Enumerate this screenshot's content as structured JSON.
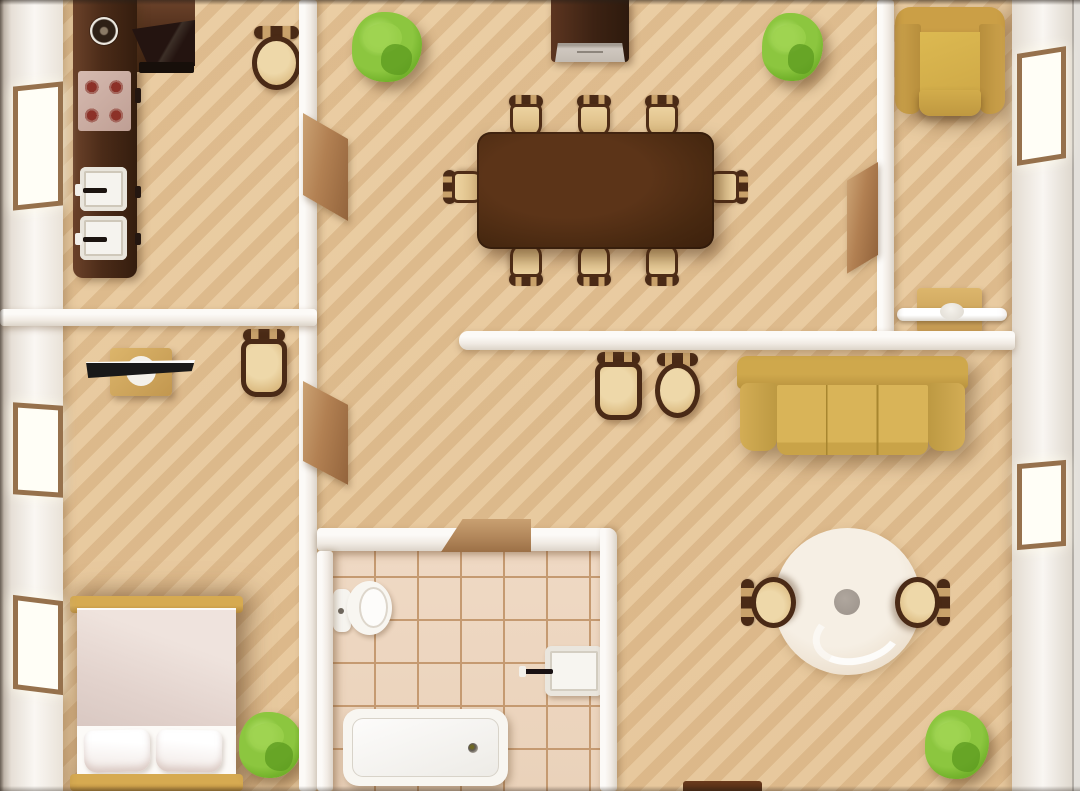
{
  "meta": {
    "title": "apartment-floor-plan-top-view",
    "width": 1080,
    "height": 791,
    "text_content": "none — illustration only"
  },
  "palette": {
    "floor": "#eacda3",
    "floor_stripe": "#c1925c",
    "wall": "#f6f2ed",
    "wall_shade": "#dcd4c9",
    "wood_dark": "#4b2b18",
    "wood_mid": "#5c3418",
    "seat_tan": "#e2c189",
    "chair_frame": "#4a2a16",
    "sofa_gold": "#cda84c",
    "armchair_gold": "#cb9f46",
    "bed_frame_gold": "#d6aa51",
    "blanket_pink": "#e2d2cc",
    "plant_green": "#8cc63f",
    "plant_dark": "#5e9c21",
    "tile": "#efd9c4",
    "grout": "#c59a71",
    "door_brown": "#b28052",
    "window_frame": "#96714c",
    "rug_cream": "#f0e6d8",
    "rug_dot_gray": "#a39a91",
    "fixture_white": "#f8f6f1",
    "stove_pink": "#d6bab0",
    "burner_red": "#8c3128",
    "tv_black": "#191919"
  },
  "rooms": [
    {
      "name": "kitchen",
      "x": 63,
      "y": 0,
      "w": 236,
      "h": 309
    },
    {
      "name": "dining-room",
      "x": 317,
      "y": 0,
      "w": 560,
      "h": 331
    },
    {
      "name": "top-right-room",
      "x": 894,
      "y": 0,
      "w": 118,
      "h": 331
    },
    {
      "name": "bedroom",
      "x": 63,
      "y": 326,
      "w": 236,
      "h": 465
    },
    {
      "name": "hall",
      "x": 317,
      "y": 350,
      "w": 142,
      "h": 178
    },
    {
      "name": "bathroom",
      "x": 333,
      "y": 551,
      "w": 267,
      "h": 240
    },
    {
      "name": "living-room",
      "x": 617,
      "y": 350,
      "w": 395,
      "h": 441
    }
  ],
  "elements": [
    {
      "n": "bathroom-tile-floor",
      "k": "bath-floor",
      "x": 333,
      "y": 551,
      "w": 267,
      "h": 240
    },
    {
      "n": "living-room-rug",
      "k": "rug",
      "x": 774,
      "y": 528,
      "w": 147,
      "h": 147,
      "ch": [
        {
          "n": "rug-center-table",
          "k": "rug-dot",
          "x": 60,
          "y": 61,
          "w": 26,
          "h": 26
        }
      ]
    },
    {
      "n": "kitchen-counter-top-run",
      "k": "kcounter-h",
      "x": 73,
      "y": 0,
      "w": 122,
      "h": 72
    },
    {
      "n": "kitchen-counter-side-run",
      "k": "kcounter-v",
      "x": 73,
      "y": 0,
      "w": 64,
      "h": 278
    },
    {
      "n": "kitchen-corner-appliance",
      "k": "kappliance",
      "x": 132,
      "y": 20,
      "w": 63,
      "h": 46
    },
    {
      "n": "kitchen-appliance-bar",
      "k": "kbar",
      "x": 139,
      "y": 62,
      "w": 55,
      "h": 11
    },
    {
      "n": "kitchen-pot",
      "k": "pot",
      "x": 90,
      "y": 17,
      "w": 28,
      "h": 28
    },
    {
      "n": "kitchen-stove",
      "k": "stove",
      "x": 78,
      "y": 71,
      "w": 53,
      "h": 60
    },
    {
      "n": "kitchen-sink-upper",
      "k": "ksink",
      "x": 80,
      "y": 167,
      "w": 47,
      "h": 44
    },
    {
      "n": "kitchen-sink-lower",
      "k": "ksink",
      "x": 80,
      "y": 216,
      "w": 47,
      "h": 44
    },
    {
      "n": "kitchen-handle-1",
      "k": "knob",
      "x": 135,
      "y": 88,
      "w": 6,
      "h": 15
    },
    {
      "n": "kitchen-handle-2",
      "k": "knob",
      "x": 135,
      "y": 186,
      "w": 6,
      "h": 12
    },
    {
      "n": "kitchen-handle-3",
      "k": "knob",
      "x": 135,
      "y": 233,
      "w": 6,
      "h": 12
    },
    {
      "n": "kitchen-stool",
      "k": "stool",
      "x": 249,
      "y": 26,
      "w": 55,
      "h": 66
    },
    {
      "n": "dining-cabinet",
      "k": "cabinet",
      "x": 551,
      "y": 0,
      "w": 78,
      "h": 62,
      "ch": [
        {
          "n": "dining-cabinet-front",
          "k": "cabinet-front",
          "x": 4,
          "y": 43,
          "w": 70,
          "h": 19
        }
      ]
    },
    {
      "n": "plant-dining-left",
      "k": "plant",
      "x": 352,
      "y": 12,
      "w": 70,
      "h": 70
    },
    {
      "n": "plant-dining-right",
      "k": "plant",
      "x": 762,
      "y": 13,
      "w": 61,
      "h": 68
    },
    {
      "n": "dining-chair-top-1",
      "k": "dchair",
      "x": 504,
      "y": 95,
      "w": 44,
      "h": 46
    },
    {
      "n": "dining-chair-top-2",
      "k": "dchair",
      "x": 572,
      "y": 95,
      "w": 44,
      "h": 46
    },
    {
      "n": "dining-chair-top-3",
      "k": "dchair",
      "x": 640,
      "y": 95,
      "w": 44,
      "h": 46
    },
    {
      "n": "dining-chair-left",
      "k": "dchair dchair--l",
      "x": 444,
      "y": 164,
      "w": 44,
      "h": 46
    },
    {
      "n": "dining-chair-right",
      "k": "dchair dchair--r",
      "x": 703,
      "y": 164,
      "w": 44,
      "h": 46
    },
    {
      "n": "dining-chair-bottom-1",
      "k": "dchair dchair--b",
      "x": 504,
      "y": 240,
      "w": 44,
      "h": 46
    },
    {
      "n": "dining-chair-bottom-2",
      "k": "dchair dchair--b",
      "x": 572,
      "y": 240,
      "w": 44,
      "h": 46
    },
    {
      "n": "dining-chair-bottom-3",
      "k": "dchair dchair--b",
      "x": 640,
      "y": 240,
      "w": 44,
      "h": 46
    },
    {
      "n": "dining-table",
      "k": "table-dining",
      "x": 477,
      "y": 132,
      "w": 237,
      "h": 117
    },
    {
      "n": "living-stool-square",
      "k": "stool stool--sq",
      "x": 592,
      "y": 352,
      "w": 53,
      "h": 70
    },
    {
      "n": "living-stool-round",
      "k": "stool",
      "x": 652,
      "y": 353,
      "w": 51,
      "h": 67
    },
    {
      "n": "sofa",
      "k": "sofa",
      "x": 737,
      "y": 356,
      "w": 231,
      "h": 101,
      "ch": [
        {
          "n": "sofa-back",
          "k": "sofa-back",
          "x": 0,
          "y": 0,
          "w": 231,
          "h": 33
        },
        {
          "n": "sofa-arm-left",
          "k": "sofa-arm",
          "x": 3,
          "y": 27,
          "w": 37,
          "h": 68
        },
        {
          "n": "sofa-arm-right",
          "k": "sofa-arm sofa-arm--r",
          "x": 191,
          "y": 27,
          "w": 37,
          "h": 68
        },
        {
          "n": "sofa-cushions",
          "k": "sofa-seat",
          "x": 40,
          "y": 29,
          "w": 151,
          "h": 70
        }
      ]
    },
    {
      "n": "rug-chair-left",
      "k": "stool stool--rugl",
      "x": 741,
      "y": 574,
      "w": 57,
      "h": 57
    },
    {
      "n": "rug-chair-right",
      "k": "stool stool--rugr",
      "x": 893,
      "y": 574,
      "w": 57,
      "h": 57
    },
    {
      "n": "plant-living",
      "k": "plant",
      "x": 925,
      "y": 710,
      "w": 64,
      "h": 69
    },
    {
      "n": "cropped-table-bottom",
      "k": "croptable",
      "x": 683,
      "y": 781,
      "w": 79,
      "h": 10
    },
    {
      "n": "armchair",
      "k": "armchair",
      "x": 895,
      "y": 7,
      "w": 110,
      "h": 112,
      "ch": [
        {
          "n": "armchair-back",
          "k": "arm-back",
          "x": 0,
          "y": 0,
          "w": 110,
          "h": 38
        },
        {
          "n": "armchair-arm-left",
          "k": "arm-side",
          "x": 0,
          "y": 17,
          "w": 26,
          "h": 90
        },
        {
          "n": "armchair-arm-right",
          "k": "arm-side arm-side--r",
          "x": 84,
          "y": 17,
          "w": 26,
          "h": 90
        },
        {
          "n": "armchair-seat",
          "k": "arm-seat",
          "x": 25,
          "y": 25,
          "w": 60,
          "h": 64
        },
        {
          "n": "armchair-front-cushion",
          "k": "arm-front",
          "x": 24,
          "y": 83,
          "w": 62,
          "h": 26
        }
      ]
    },
    {
      "n": "console",
      "k": "console",
      "x": 897,
      "y": 287,
      "w": 110,
      "h": 47,
      "ch": [
        {
          "n": "console-table",
          "k": "console-table",
          "x": 20,
          "y": 1,
          "w": 65,
          "h": 45
        },
        {
          "n": "console-shelf",
          "k": "console-shelf",
          "x": 0,
          "y": 21,
          "w": 110,
          "h": 13
        },
        {
          "n": "console-knob",
          "k": "console-knob",
          "x": 43,
          "y": 16,
          "w": 24,
          "h": 17
        }
      ]
    },
    {
      "n": "tv-desk",
      "k": "tvdesk",
      "x": 86,
      "y": 344,
      "w": 110,
      "h": 53,
      "ch": [
        {
          "n": "desk-top",
          "k": "desk-top",
          "x": 24,
          "y": 4,
          "w": 62,
          "h": 48
        },
        {
          "n": "tv-stand",
          "k": "tv-stand",
          "x": 40,
          "y": 12,
          "w": 30,
          "h": 30
        },
        {
          "n": "tv-screen",
          "k": "tv-screen",
          "x": 0,
          "y": 16,
          "w": 109,
          "h": 18
        }
      ]
    },
    {
      "n": "desk-chair",
      "k": "stool stool--sq",
      "x": 238,
      "y": 329,
      "w": 52,
      "h": 70
    },
    {
      "n": "bed",
      "k": "bed",
      "x": 70,
      "y": 594,
      "w": 173,
      "h": 197,
      "ch": [
        {
          "n": "bed-headboard",
          "k": "bed-bar",
          "x": 0,
          "y": 2,
          "w": 173,
          "h": 17
        },
        {
          "n": "bed-mattress",
          "k": "bed-body",
          "x": 7,
          "y": 14,
          "w": 159,
          "h": 168
        },
        {
          "n": "bed-blanket",
          "k": "bed-blanket",
          "x": 7,
          "y": 16,
          "w": 159,
          "h": 116
        },
        {
          "n": "bed-pillow-left",
          "k": "bed-pillow",
          "x": 14,
          "y": 136,
          "w": 66,
          "h": 42,
          "t": "rotate(-1.5deg)"
        },
        {
          "n": "bed-pillow-right",
          "k": "bed-pillow",
          "x": 86,
          "y": 136,
          "w": 66,
          "h": 42,
          "t": "rotate(1deg)"
        },
        {
          "n": "bed-footboard",
          "k": "bed-bar",
          "x": 0,
          "y": 180,
          "w": 173,
          "h": 17
        }
      ]
    },
    {
      "n": "plant-bedroom",
      "k": "plant",
      "x": 239,
      "y": 712,
      "w": 63,
      "h": 66
    },
    {
      "n": "toilet",
      "k": "toilet",
      "x": 333,
      "y": 580,
      "w": 59,
      "h": 58,
      "ch": [
        {
          "n": "toilet-tank",
          "k": "toilet-tank",
          "x": 0,
          "y": 9,
          "w": 18,
          "h": 43
        },
        {
          "n": "toilet-bowl",
          "k": "toilet-bowl",
          "x": 14,
          "y": 1,
          "w": 45,
          "h": 54
        }
      ]
    },
    {
      "n": "bathroom-sink",
      "k": "sink-b",
      "x": 545,
      "y": 646,
      "w": 58,
      "h": 50
    },
    {
      "n": "bathtub",
      "k": "tub",
      "x": 343,
      "y": 709,
      "w": 165,
      "h": 77
    },
    {
      "n": "wall-outer-left",
      "k": "wall-outer-left",
      "x": 0,
      "y": 0,
      "w": 63,
      "h": 791
    },
    {
      "n": "wall-outer-right",
      "k": "wall-outer-right",
      "x": 1012,
      "y": 0,
      "w": 62,
      "h": 791
    },
    {
      "n": "wall-outer-right-edge",
      "k": "wall-edge-right",
      "x": 1072,
      "y": 0,
      "w": 8,
      "h": 791
    },
    {
      "n": "wall-center-vertical",
      "k": "wall-v",
      "x": 299,
      "y": 0,
      "w": 18,
      "h": 791
    },
    {
      "n": "wall-kitchen-bottom",
      "k": "wall-h",
      "x": 0,
      "y": 309,
      "w": 317,
      "h": 17
    },
    {
      "n": "wall-dining-right",
      "k": "wall-v",
      "x": 877,
      "y": 0,
      "w": 17,
      "h": 350
    },
    {
      "n": "wall-living-top",
      "k": "wall-h wall-cap-left",
      "x": 459,
      "y": 331,
      "w": 556,
      "h": 19
    },
    {
      "n": "wall-bath-top",
      "k": "wall-h",
      "x": 317,
      "y": 528,
      "w": 296,
      "h": 23
    },
    {
      "n": "wall-bath-right",
      "k": "wall-v wall-cap-tr",
      "x": 600,
      "y": 528,
      "w": 17,
      "h": 263
    },
    {
      "n": "wall-bath-left",
      "k": "wall-v",
      "x": 317,
      "y": 551,
      "w": 16,
      "h": 240
    },
    {
      "n": "window-left-kitchen",
      "k": "window",
      "x": 13,
      "y": 84,
      "w": 50,
      "h": 124,
      "t": "skewY(-6deg)"
    },
    {
      "n": "window-left-bedroom-1",
      "k": "window",
      "x": 13,
      "y": 404,
      "w": 50,
      "h": 92,
      "t": "skewY(4deg)"
    },
    {
      "n": "window-left-bedroom-2",
      "k": "window",
      "x": 13,
      "y": 598,
      "w": 50,
      "h": 94,
      "t": "skewY(7deg)"
    },
    {
      "n": "window-right-top",
      "k": "window",
      "x": 1017,
      "y": 50,
      "w": 49,
      "h": 112,
      "t": "skewY(-9deg)"
    },
    {
      "n": "window-right-living",
      "k": "window",
      "x": 1017,
      "y": 462,
      "w": 49,
      "h": 86,
      "t": "skewY(-5deg)"
    },
    {
      "n": "door-kitchen",
      "k": "door-v",
      "x": 303,
      "y": 113,
      "w": 45,
      "h": 82,
      "t": "skewY(30deg)",
      "o": "left top"
    },
    {
      "n": "door-bedroom",
      "k": "door-v",
      "x": 303,
      "y": 381,
      "w": 45,
      "h": 80,
      "t": "skewY(28deg)",
      "o": "left top"
    },
    {
      "n": "door-top-right-room",
      "k": "door-v",
      "x": 847,
      "y": 162,
      "w": 31,
      "h": 93,
      "t": "skewY(-31deg)",
      "o": "right top"
    },
    {
      "n": "door-bathroom",
      "k": "door-flat",
      "x": 441,
      "y": 519,
      "w": 90,
      "h": 33
    },
    {
      "n": "edge-shadow-top",
      "k": "shade-top",
      "x": 0,
      "y": 0,
      "w": 1080,
      "h": 5
    },
    {
      "n": "edge-shadow-left",
      "k": "shade-left",
      "x": 0,
      "y": 0,
      "w": 4,
      "h": 791
    },
    {
      "n": "edge-shadow-bottom",
      "k": "shade-bottom",
      "x": 0,
      "y": 786,
      "w": 1080,
      "h": 5
    },
    {
      "n": "vignette-overlay",
      "k": "vignette",
      "x": 0,
      "y": 0,
      "w": 1080,
      "h": 791
    }
  ]
}
